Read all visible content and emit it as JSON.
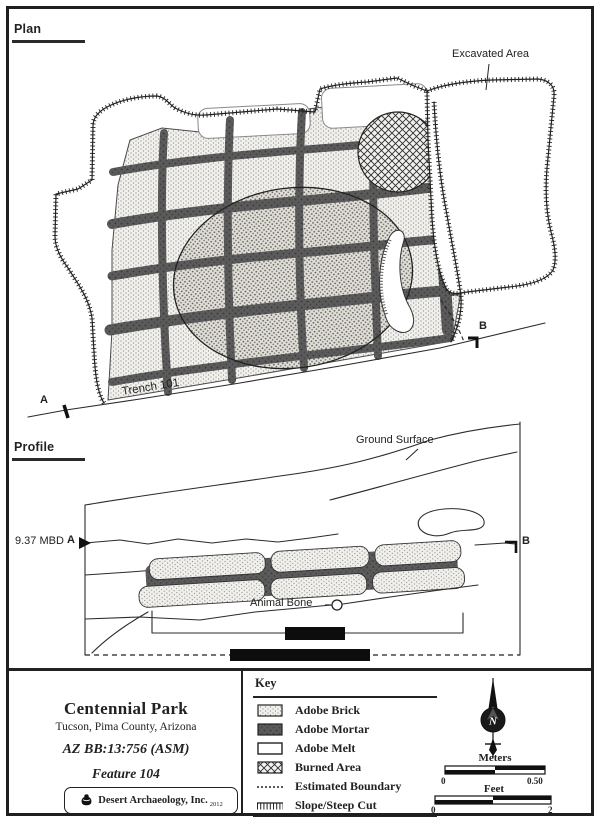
{
  "colors": {
    "ink": "#222222",
    "mortar": "#575757",
    "paper": "#ffffff"
  },
  "plan": {
    "section_label": "Plan",
    "excavated_area_label": "Excavated Area",
    "trench_label": "Trench 101",
    "marker_a": "A",
    "marker_b": "B"
  },
  "profile": {
    "section_label": "Profile",
    "ground_surface_label": "Ground Surface",
    "elevation_label": "9.37 MBD",
    "marker_a": "A",
    "marker_b": "B",
    "animal_bone_label": "Animal Bone"
  },
  "title_block": {
    "site_name": "Centennial Park",
    "location": "Tucson, Pima County, Arizona",
    "site_number": "AZ BB:13:756 (ASM)",
    "feature": "Feature 104",
    "company": "Desert Archaeology, Inc.",
    "year": "2012"
  },
  "key": {
    "title": "Key",
    "items": [
      {
        "label": "Adobe Brick",
        "swatch": "stipple"
      },
      {
        "label": "Adobe Mortar",
        "swatch": "dark-mortar"
      },
      {
        "label": "Adobe Melt",
        "swatch": "white"
      },
      {
        "label": "Burned Area",
        "swatch": "crosshatch"
      },
      {
        "label": "Estimated Boundary",
        "swatch": "dashed-line"
      },
      {
        "label": "Slope/Steep Cut",
        "swatch": "hachure-line"
      }
    ]
  },
  "compass": {
    "north_label": "N"
  },
  "scales": {
    "meters": {
      "label": "Meters",
      "start": "0",
      "end": "0.50"
    },
    "feet": {
      "label": "Feet",
      "start": "0",
      "end": "2"
    }
  }
}
